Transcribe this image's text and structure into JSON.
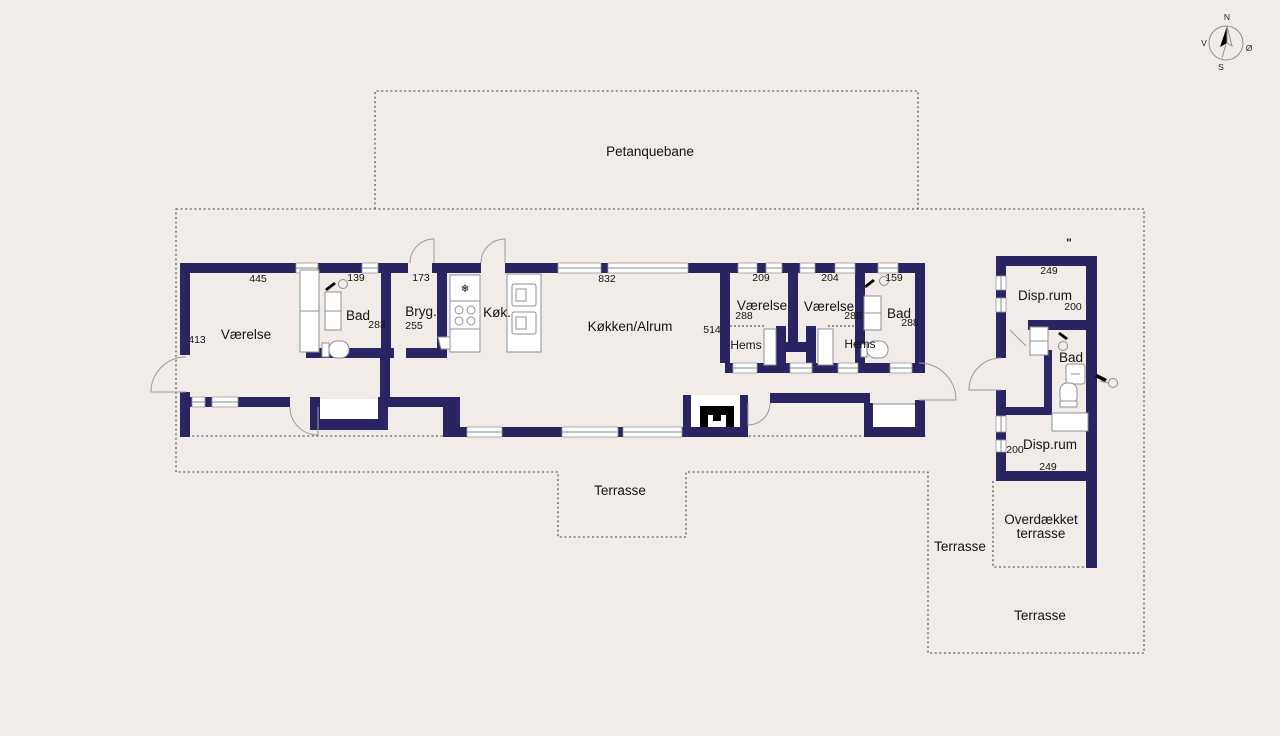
{
  "colors": {
    "wall": "#2b2462",
    "background": "#f1ece7",
    "dotted_line": "#454545",
    "fixture_stroke": "#8f9093"
  },
  "compass": {
    "north": "N",
    "east": "Ø",
    "south": "S",
    "west": "V"
  },
  "site": {
    "petanque_label": "Petanquebane",
    "terrace_south_label": "Terrasse",
    "terrace_annex_west_label": "Terrasse",
    "terrace_annex_south_label": "Terrasse",
    "covered_terrace_line1": "Overdækket",
    "covered_terrace_line2": "terrasse",
    "ditto_mark": "\""
  },
  "main_house": {
    "bedroom_west": {
      "label": "Værelse",
      "width_cm": "445",
      "depth_cm": "413"
    },
    "bath_west": {
      "label": "Bad",
      "width_cm": "139",
      "depth_cm": "283"
    },
    "utility": {
      "label": "Bryg.",
      "width_cm": "173",
      "depth_cm": "255"
    },
    "kitchen": {
      "label": "Køk."
    },
    "kitchen_living": {
      "label": "Køkken/Alrum",
      "width_cm": "832",
      "depth_cm": "514"
    },
    "bedroom_mid1": {
      "label": "Værelse",
      "width_cm": "209",
      "depth_cm": "288",
      "loft_label": "Hems"
    },
    "bedroom_mid2": {
      "label": "Værelse",
      "width_cm": "204",
      "depth_cm": "288",
      "loft_label": "Hems"
    },
    "bath_east": {
      "label": "Bad",
      "width_cm": "159",
      "depth_cm": "288"
    }
  },
  "annex": {
    "storage_north": {
      "label": "Disp.rum",
      "width_cm": "249",
      "depth_cm": "200"
    },
    "bath": {
      "label": "Bad"
    },
    "storage_south": {
      "label": "Disp.rum",
      "width_cm": "249",
      "depth_cm": "200"
    }
  },
  "icons": {
    "fridge_snowflake": "❄"
  }
}
